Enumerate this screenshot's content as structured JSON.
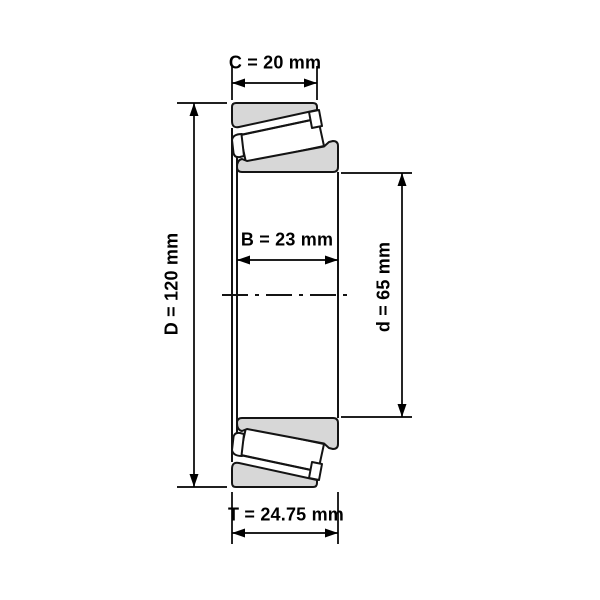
{
  "diagram": {
    "kind": "tapered-roller-bearing cross-section dimension drawing",
    "labels": {
      "C": "C = 20 mm",
      "B": "B = 23 mm",
      "T": "T = 24.75 mm",
      "D": "D = 120 mm",
      "d": "d = 65 mm"
    },
    "colors": {
      "ring_fill": "#d7d7d7",
      "roller_fill": "#ffffff",
      "outline": "#141414",
      "dimension": "#000000",
      "background": "#ffffff"
    }
  }
}
